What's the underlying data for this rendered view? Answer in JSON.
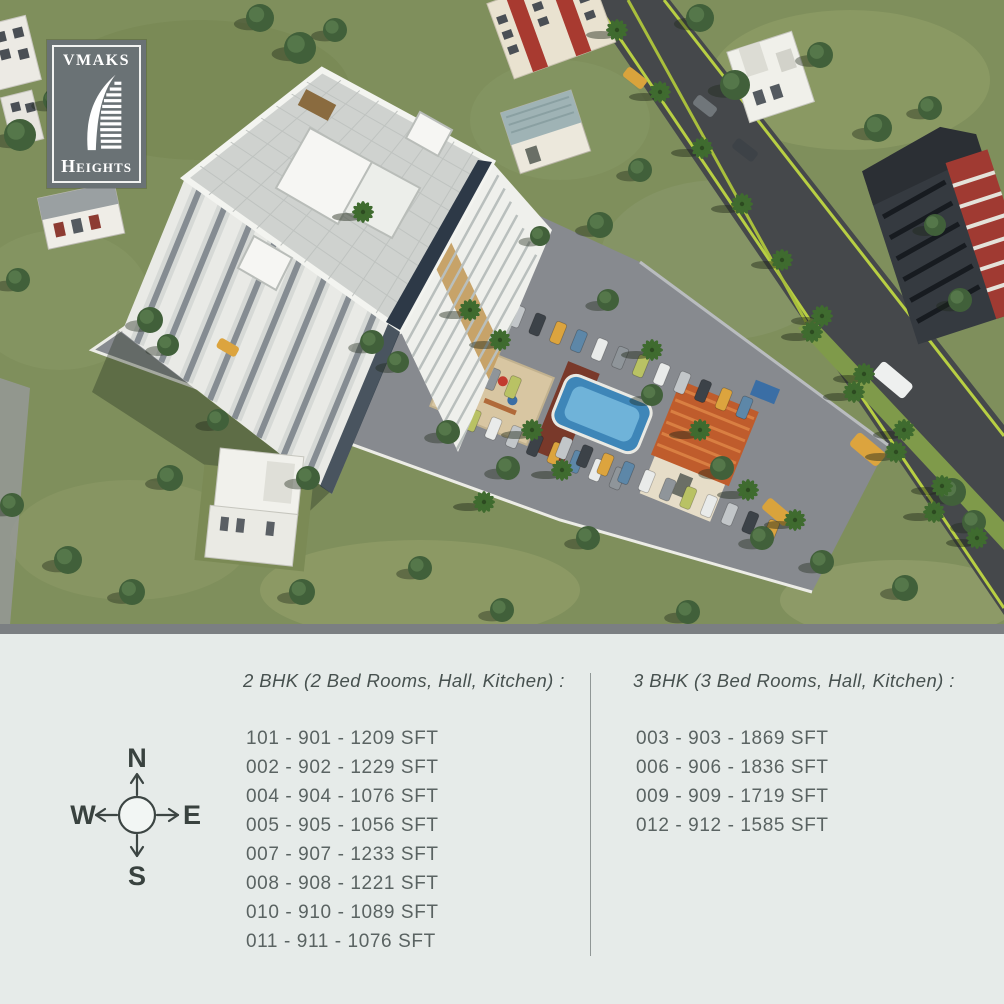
{
  "logo": {
    "brand": "VMAKS",
    "product": "Heights",
    "icon": "sail-tower-icon"
  },
  "compass": {
    "north": "N",
    "south": "S",
    "east": "E",
    "west": "W"
  },
  "legend": {
    "bhk2": {
      "heading": "2 BHK (2 Bed Rooms, Hall, Kitchen) :",
      "units": [
        "101 - 901 - 1209 SFT",
        "002 - 902 - 1229 SFT",
        "004 - 904 - 1076 SFT",
        "005 - 905 - 1056 SFT",
        "007 - 907 - 1233 SFT",
        "008 - 908 - 1221 SFT",
        "010 - 910 - 1089 SFT",
        "011 - 911 - 1076 SFT"
      ]
    },
    "bhk3": {
      "heading": "3 BHK (3 Bed Rooms, Hall, Kitchen) :",
      "units": [
        "003 - 903 - 1869 SFT",
        "006 - 906 - 1836 SFT",
        "009 - 909 - 1719 SFT",
        "012 - 912 - 1585 SFT"
      ]
    }
  },
  "palette": {
    "panel_bg": "#e6ebe9",
    "separator_bar": "#7b7f82",
    "heading_text": "#47514f",
    "list_text": "#5a6362",
    "logo_bg": "#6a7275",
    "grass": "#7f8f5c",
    "road": "#46494c",
    "pavement": "#878a8f",
    "pool_blue": "#3e86b8",
    "clubhouse_roof": "#bf5c2c",
    "taxi_yellow": "#dca43e"
  }
}
